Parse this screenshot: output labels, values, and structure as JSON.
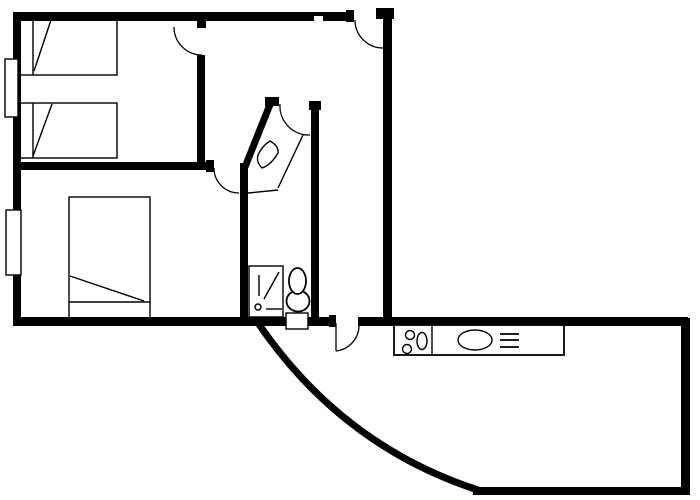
{
  "document": {
    "kind": "floor-plan-line-drawing",
    "background_color": "#ffffff",
    "ink_color": "#000000"
  },
  "plan": {
    "wall_style": "solid-black",
    "door_count": 5,
    "window_count": 2,
    "rooms": [
      {
        "id": "bedroom-1",
        "fixtures": [
          "twin-bed-upper",
          "twin-bed-lower",
          "window"
        ]
      },
      {
        "id": "bedroom-2",
        "fixtures": [
          "double-bed",
          "window"
        ]
      },
      {
        "id": "hallway",
        "fixtures": [
          "corner-closet",
          "closet-ornament"
        ]
      },
      {
        "id": "bathroom",
        "fixtures": [
          "shower-stall",
          "shower-spray-symbol",
          "toilet",
          "threshold"
        ]
      },
      {
        "id": "living-kitchen",
        "fixtures": [
          "kitchen-counter",
          "burner",
          "burner",
          "hob-oval",
          "sink-basin",
          "vent-grille"
        ]
      }
    ],
    "special_walls": [
      "curved-exterior-wall"
    ]
  }
}
